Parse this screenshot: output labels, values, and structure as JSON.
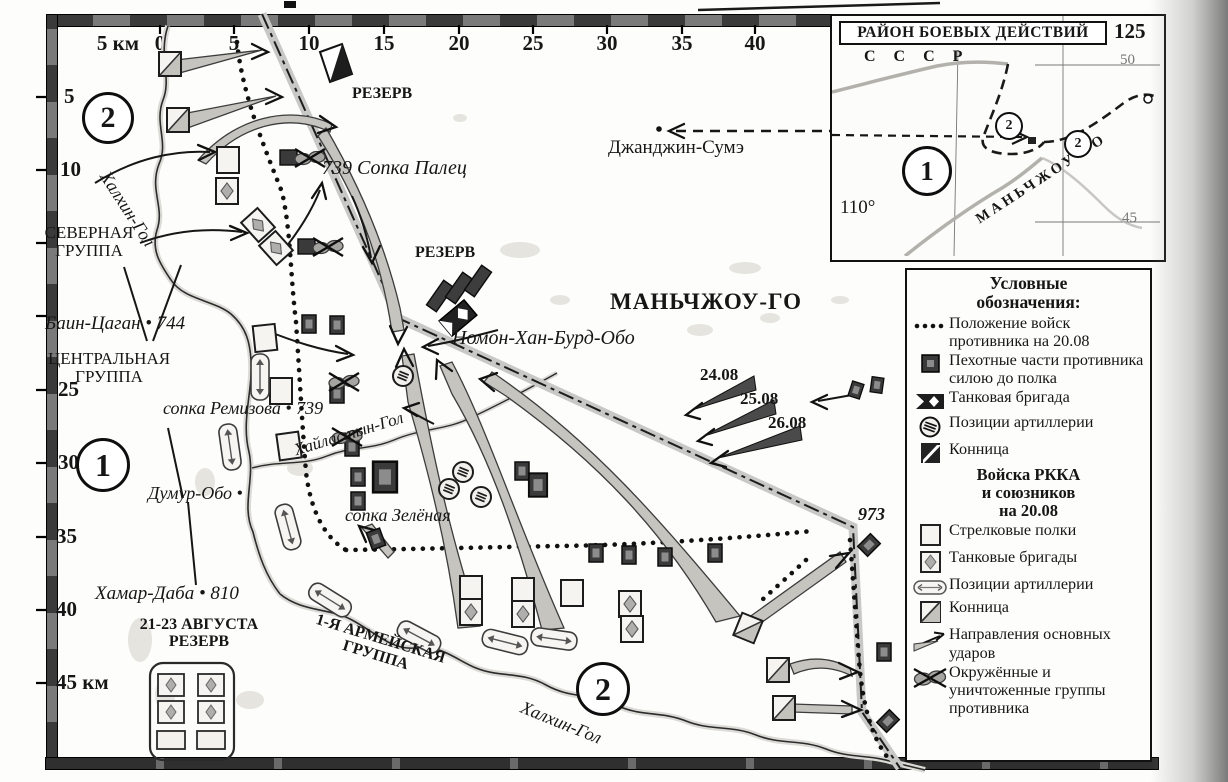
{
  "scale_top": {
    "km_label": "5 км",
    "ticks": [
      "0",
      "5",
      "10",
      "15",
      "20",
      "25",
      "30",
      "35",
      "40"
    ]
  },
  "scale_left": {
    "ticks": [
      "5",
      "10",
      "25",
      "30",
      "35",
      "40"
    ],
    "last_label": "45 км"
  },
  "groups": {
    "north_badge": "2",
    "center_badge": "1",
    "south_badge": "2"
  },
  "labels": {
    "reserve_top": "РЕЗЕРВ",
    "dzhandzhin_sume": "Джанджин-Сумэ",
    "sopka_palets": "739 Сопка Палец",
    "severnaya_1": "СЕВЕРНАЯ",
    "severnaya_2": "ГРУППА",
    "khalkhin_gol_upper": "Халхин-Гол",
    "bain_tsagan": "Баин-Цаган • 744",
    "tsentralnaya_1": "ЦЕНТРАЛЬНАЯ",
    "tsentralnaya_2": "ГРУППА",
    "reserve_mid": "РЕЗЕРВ",
    "nomon_khan": "Номон-Хан-Бурд-Обо",
    "manchukuo": "МАНЬЧЖОУ-ГО",
    "sopka_remizova": "сопка Ремизова • 739",
    "khailastyn_gol": "Хайластын-Гол",
    "dumur_obo": "Думур-Обо •",
    "sopka_zelyonaya": "сопка Зелёная",
    "khamar_daba": "Хамар-Даба • 810",
    "reserve_aug_1": "21-23 АВГУСТА",
    "reserve_aug_2": "РЕЗЕРВ",
    "army_group_1": "1-Я АРМЕЙСКАЯ",
    "army_group_2": "ГРУППА",
    "khalkhin_gol_lower": "Халхин-Гол",
    "date_1": "24.08",
    "date_2": "25.08",
    "date_3": "26.08",
    "height_973": "973"
  },
  "inset": {
    "title": "РАЙОН БОЕВЫХ ДЕЙСТВИЙ",
    "lon_right": "125",
    "lon_left": "110°",
    "ussr": "С С С Р",
    "manchukuo": "МАНЬЧЖОУ-ГО",
    "lat_top": "50",
    "lat_bottom": "45",
    "badge_1": "1",
    "badge_2a": "2",
    "badge_2b": "2"
  },
  "legend": {
    "title_1": "Условные",
    "title_2": "обозначения:",
    "enemy_items": [
      {
        "label": "Положение войск противника на 20.08"
      },
      {
        "label": "Пехотные части противника силою до полка"
      },
      {
        "label": "Танковая бригада"
      },
      {
        "label": "Позиции артиллерии"
      },
      {
        "label": "Конница"
      }
    ],
    "rkka_header_1": "Войска РККА",
    "rkka_header_2": "и союзников",
    "rkka_header_3": "на 20.08",
    "rkka_items": [
      {
        "label": "Стрелковые полки"
      },
      {
        "label": "Танковые бригады"
      },
      {
        "label": "Позиции артиллерии"
      },
      {
        "label": "Конница"
      },
      {
        "label": "Направления основных ударов"
      },
      {
        "label": "Окружённые и уничтоженные группы противника"
      }
    ]
  }
}
